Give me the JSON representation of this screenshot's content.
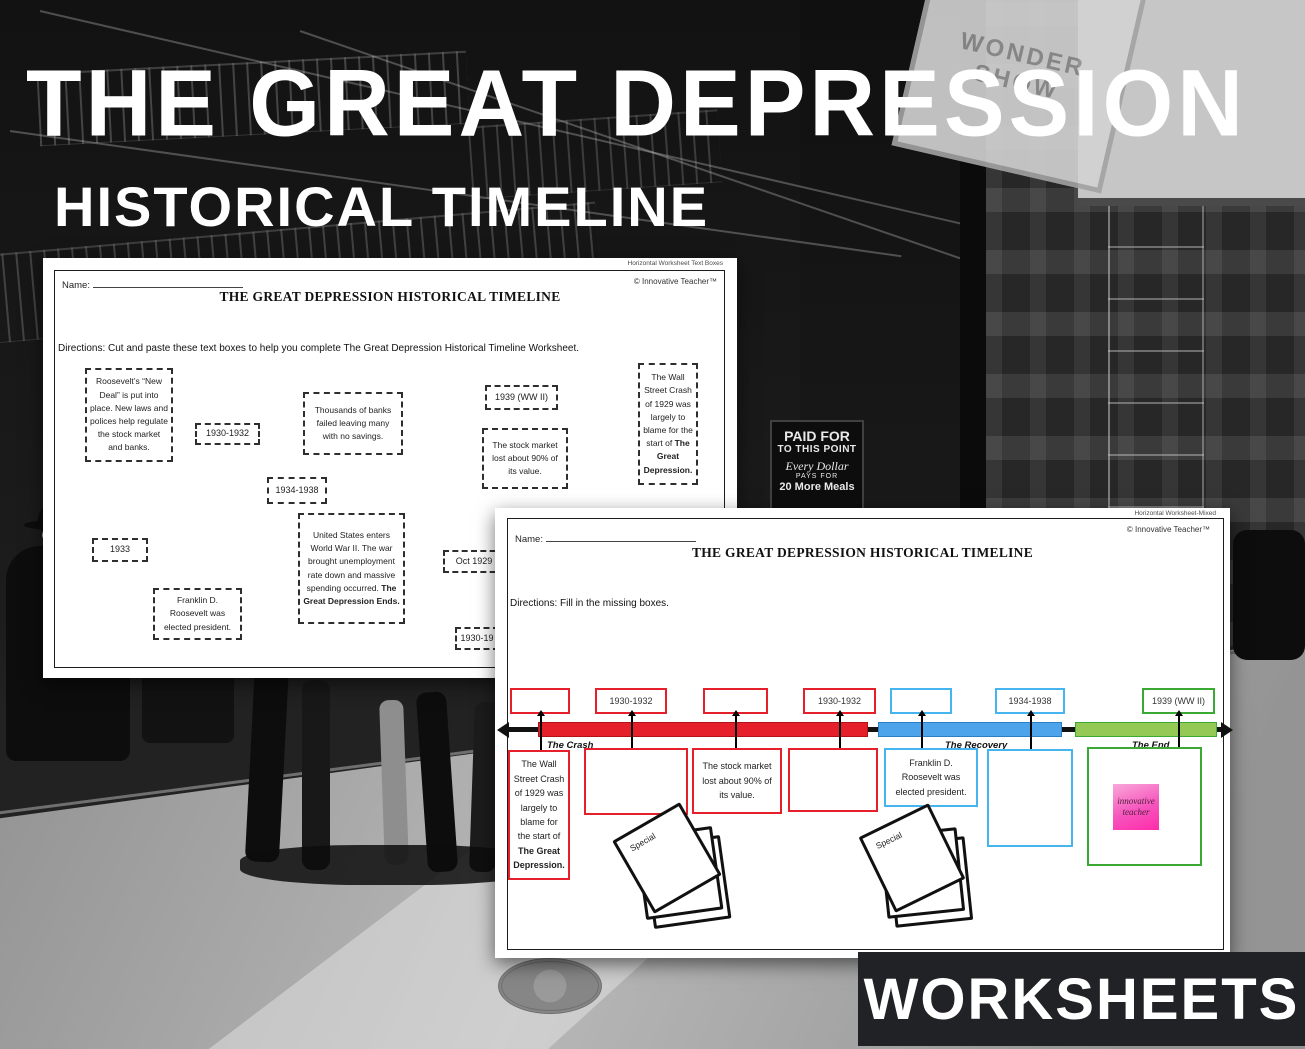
{
  "cover": {
    "title": "THE GREAT DEPRESSION",
    "subtitle": "HISTORICAL TIMELINE",
    "banner": "WORKSHEETS",
    "background": {
      "billboard_text": "WONDER SHOW",
      "paid_sign": {
        "line1": "PAID FOR",
        "line2": "TO THIS POINT",
        "line3": "Every Dollar",
        "line4": "PAYS FOR",
        "line5": "20 More Meals"
      }
    }
  },
  "worksheet_textboxes": {
    "page_label": "Horizontal Worksheet Text Boxes",
    "copyright": "© Innovative Teacher™",
    "name_label": "Name:",
    "title": "THE GREAT DEPRESSION HISTORICAL TIMELINE",
    "directions": "Directions: Cut and paste these text boxes to help you complete The Great Depression Historical Timeline Worksheet.",
    "boxes": [
      {
        "text": "Roosevelt’s “New Deal” is put into place. New laws and polices help regulate the stock market and banks.",
        "bold": ""
      },
      {
        "text": "1930-1932",
        "bold": ""
      },
      {
        "text": "Thousands of banks failed leaving many with no savings.",
        "bold": ""
      },
      {
        "text": "1934-1938",
        "bold": ""
      },
      {
        "text": "1939 (WW II)",
        "bold": ""
      },
      {
        "text": "The stock market lost about 90% of its value.",
        "bold": ""
      },
      {
        "text": "The Wall Street Crash of 1929 was largely to blame for the start of",
        "bold": "The Great Depression."
      },
      {
        "text": "1933",
        "bold": ""
      },
      {
        "text": "United States enters World War II.  The war brought unemployment rate down and massive spending occurred.",
        "bold": "The Great Depression Ends."
      },
      {
        "text": "Franklin D. Roosevelt was elected president.",
        "bold": ""
      },
      {
        "text": "Oct 1929",
        "bold": ""
      },
      {
        "text": "1930-19",
        "bold": ""
      }
    ]
  },
  "worksheet_mixed": {
    "page_label": "Horizontal Worksheet-Mixed",
    "copyright": "© Innovative Teacher™",
    "name_label": "Name:",
    "title": "THE GREAT DEPRESSION HISTORICAL TIMELINE",
    "directions": "Directions: Fill in the missing boxes.",
    "timeline": {
      "top_boxes": [
        {
          "label": "",
          "color": "red"
        },
        {
          "label": "1930-1932",
          "color": "red"
        },
        {
          "label": "",
          "color": "red"
        },
        {
          "label": "1930-1932",
          "color": "red"
        },
        {
          "label": "",
          "color": "blue"
        },
        {
          "label": "1934-1938",
          "color": "blue"
        },
        {
          "label": "1939 (WW II)",
          "color": "green"
        }
      ],
      "segments": [
        {
          "label": "The Crash",
          "color": "#e5202a"
        },
        {
          "label": "The Recovery",
          "color": "#4da4ea"
        },
        {
          "label": "The End",
          "color": "#93c954"
        }
      ],
      "bottom_boxes": [
        {
          "text": "The Wall Street Crash of 1929 was largely to blame for the start of",
          "bold": "The Great Depression.",
          "color": "red"
        },
        {
          "text": "",
          "bold": "",
          "color": "red"
        },
        {
          "text": "The stock market lost about 90% of its value.",
          "bold": "",
          "color": "red"
        },
        {
          "text": "",
          "bold": "",
          "color": "red"
        },
        {
          "text": "Franklin D. Roosevelt was elected president.",
          "bold": "",
          "color": "blue"
        },
        {
          "text": "",
          "bold": "",
          "color": "blue"
        },
        {
          "text": "",
          "bold": "",
          "color": "green"
        }
      ]
    },
    "special_label": "Special",
    "logo_text": "innovative teacher"
  },
  "colors": {
    "box_red": "#e5202a",
    "box_blue": "#45b4ef",
    "box_green": "#3aaa35",
    "segment_red": "#e5202a",
    "segment_blue": "#4da4ea",
    "segment_green": "#93c954",
    "logo_pink": "#ff2bab"
  }
}
